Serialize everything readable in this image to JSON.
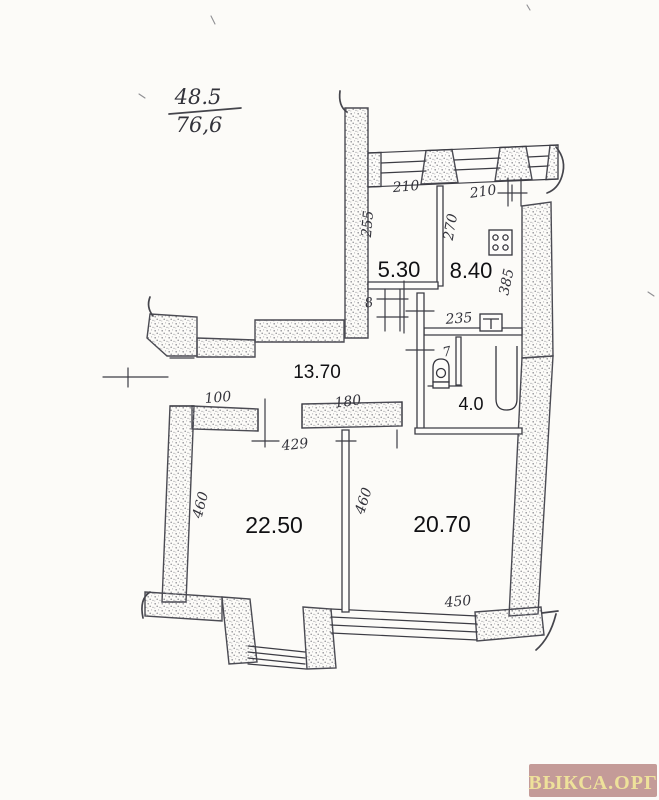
{
  "area_summary": {
    "numerator": "48.5",
    "denominator": "76,6"
  },
  "floor_plan": {
    "room_areas": {
      "pantry": "5.30",
      "kitchen": "8.40",
      "hall": "13.70",
      "bathroom": "4.0",
      "living_room": "22.50",
      "bedroom": "20.70"
    },
    "dimensions": {
      "top_window_left": "210",
      "top_window_right": "210",
      "pantry_depth": "255",
      "kitchen_depth": "270",
      "kitchen_right_side": "385",
      "kitchen_width": "235",
      "wc_door": "7",
      "pantry_door": "8",
      "entry_opening": "100",
      "hall_opening": "180",
      "living_room_width": "429",
      "living_room_depth": "460",
      "bedroom_depth": "460",
      "bedroom_width": "450"
    },
    "fixtures": [
      "stove",
      "sink",
      "toilet",
      "bathtub"
    ]
  },
  "watermark": {
    "text": "ВЫКСА.ОРГ",
    "bg_color": "#c49b98",
    "text_color": "#eee19a"
  },
  "colors": {
    "paper": "#fcfbf8",
    "ink": "#3c3c44"
  }
}
